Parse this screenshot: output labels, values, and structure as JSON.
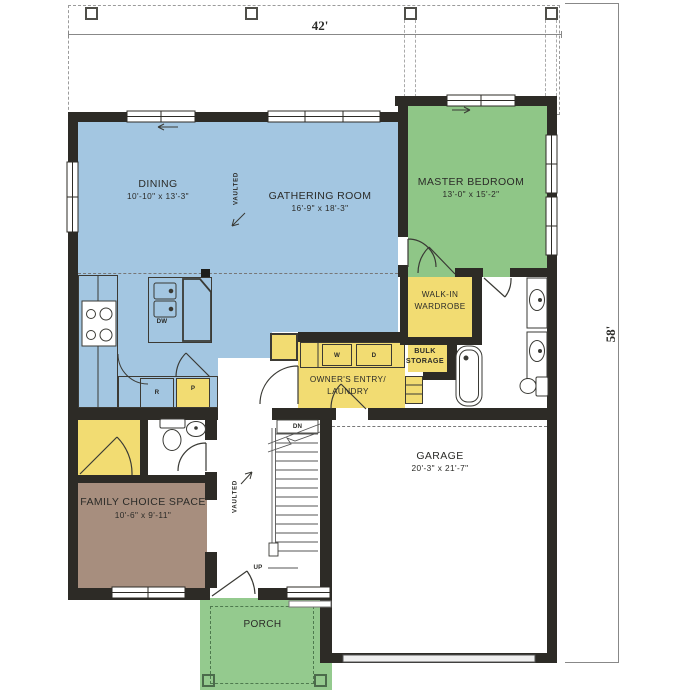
{
  "dimensions": {
    "width": "42'",
    "depth": "58'"
  },
  "rooms": {
    "dining": {
      "name": "DINING",
      "size": "10'-10\" x 13'-3\""
    },
    "gathering_room": {
      "name": "GATHERING ROOM",
      "size": "16'-9\" x 18'-3\""
    },
    "master_bedroom": {
      "name": "MASTER BEDROOM",
      "size": "13'-0\" x 15'-2\""
    },
    "walk_in_wardrobe": {
      "line1": "WALK-IN",
      "line2": "WARDROBE"
    },
    "bulk_storage": {
      "line1": "BULK",
      "line2": "STORAGE"
    },
    "owners_entry_laundry": {
      "line1": "OWNER'S ENTRY/",
      "line2": "LAUNDRY"
    },
    "family_choice_space": {
      "name": "FAMILY CHOICE SPACE",
      "size": "10'-6\" x 9'-11\""
    },
    "garage": {
      "name": "GARAGE",
      "size": "20'-3\" x 21'-7\""
    },
    "porch": {
      "name": "PORCH"
    }
  },
  "annotations": {
    "vaulted": "VAULTED",
    "down": "DN",
    "up": "UP"
  },
  "fixtures": {
    "dishwasher": "DW",
    "range": "R",
    "pantry": "P",
    "washer": "W",
    "dryer": "D"
  },
  "colors": {
    "living_area": "#a3c6e1",
    "bedroom": "#8fc687",
    "porch": "#94ca8e",
    "utility": "#f2dc72",
    "flex_space": "#a78e7e",
    "wall": "#2d2b26"
  }
}
